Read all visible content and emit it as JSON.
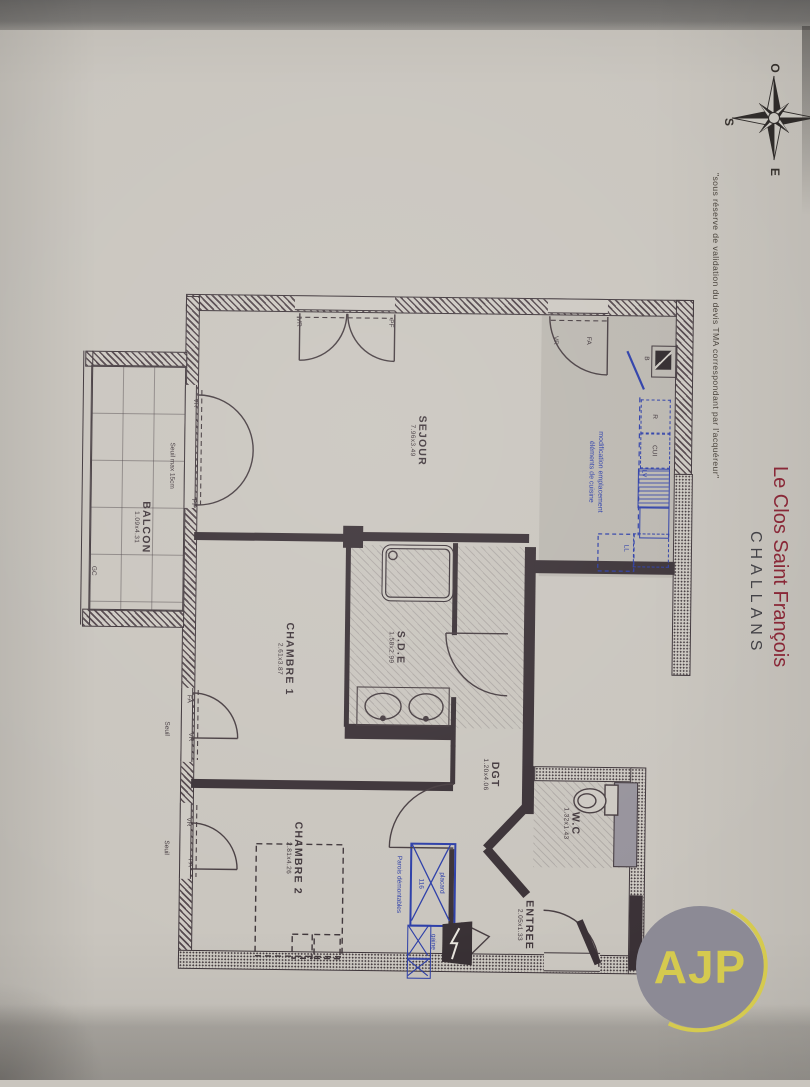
{
  "page": {
    "disclaimer": "\"sous réserve de validation du devis TMA correspondant par l'acquéreur\"",
    "project": "Le Clos Saint François",
    "city": "CHALLANS",
    "logo": "AJP"
  },
  "compass": {
    "o": "O",
    "s": "S",
    "e": "E"
  },
  "rooms": {
    "sejour": {
      "name": "SEJOUR",
      "dim": "7.96x3.49"
    },
    "balcon": {
      "name": "BALCON",
      "dim": "1.09x4.31"
    },
    "chambre1": {
      "name": "CHAMBRE 1",
      "dim": "2.61x3.87"
    },
    "sde": {
      "name": "S.D.E",
      "dim": "1.58x2.99"
    },
    "dgt": {
      "name": "DGT",
      "dim": "1.20x4.06"
    },
    "wc": {
      "name": "W.C",
      "dim": "1.32x1.43"
    },
    "chambre2": {
      "name": "CHAMBRE 2",
      "dim": "2.81x4.26"
    },
    "entree": {
      "name": "ENTREE",
      "dim": "2.05x1.33"
    }
  },
  "annotations": {
    "kitchen_note_line1": "modification emplacement",
    "kitchen_note_line2": "éléments de cuisine",
    "parois": "Parois démontables",
    "placard": "placard",
    "placard_width": "116",
    "gaine": "gaine",
    "seuil_max": "Seuil max 15cm",
    "seuil": "Seuil",
    "gc": "GC"
  },
  "tags": {
    "vr": "VR",
    "pf": "PF",
    "fa": "FA",
    "r": "R",
    "cui": "CUI",
    "lv": "LV",
    "ll": "LL",
    "b": "B"
  }
}
